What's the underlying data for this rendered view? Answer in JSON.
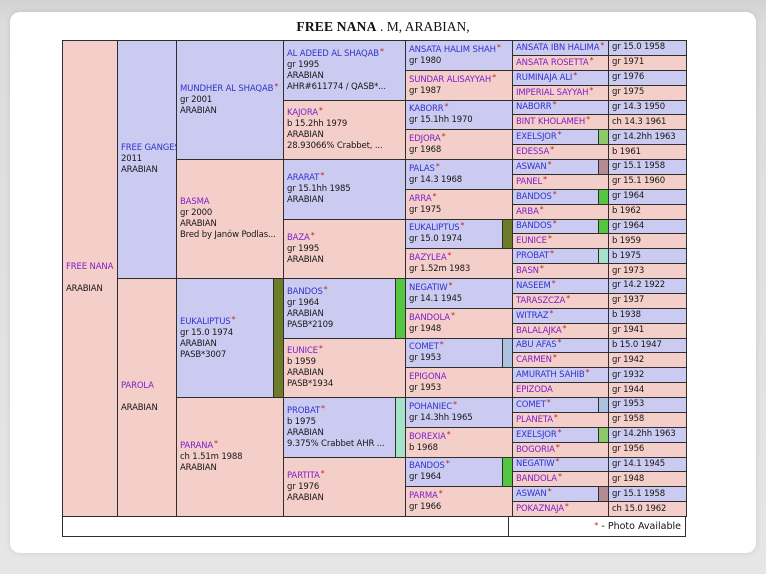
{
  "page": {
    "title_name": "FREE NANA",
    "title_suffix": " . M, ARABIAN,"
  },
  "footer": {
    "star": "*",
    "note": "- Photo Available"
  },
  "colors": {
    "male_bg": "#cbcbf1",
    "female_bg": "#f4cfca",
    "male_name": "#3232cd",
    "female_name": "#7d1ec8",
    "photo_star": "#c42222",
    "border": "#2e2e2e",
    "dup_eukaliptus": "#6e7b28",
    "dup_bandos": "#54c641",
    "dup_probat": "#a4e3c8",
    "dup_comet": "#aac4de",
    "dup_exelsjor": "#8bc96b",
    "dup_aswan": "#b28b93"
  },
  "pedigree": {
    "columns": [
      {
        "cells": [
          {
            "span": 32,
            "sex": "f",
            "name": "FREE NANA",
            "details": [
              "",
              "ARABIAN"
            ]
          }
        ]
      },
      {
        "cells": [
          {
            "span": 16,
            "sex": "m",
            "name": "FREE GANGES",
            "details": [
              "2011",
              "ARABIAN"
            ]
          },
          {
            "span": 16,
            "sex": "f",
            "name": "PAROLA",
            "details": [
              "",
              "ARABIAN"
            ]
          }
        ]
      },
      {
        "cells": [
          {
            "span": 8,
            "sex": "m",
            "name": "MUNDHER AL SHAQAB",
            "star": "*",
            "details": [
              "gr 2001",
              "ARABIAN"
            ]
          },
          {
            "span": 8,
            "sex": "f",
            "name": "BASMA",
            "details": [
              "gr 2000",
              "ARABIAN",
              "Bred by Janów Podlas..."
            ]
          },
          {
            "span": 8,
            "sex": "m",
            "name": "EUKALIPTUS",
            "star": "*",
            "details": [
              "gr 15.0 1974",
              "ARABIAN",
              "PASB*3007"
            ],
            "dup_color": "#6e7b28"
          },
          {
            "span": 8,
            "sex": "f",
            "name": "PARANA",
            "star": "*",
            "details": [
              "ch 1.51m 1988",
              "ARABIAN"
            ]
          }
        ]
      },
      {
        "cells": [
          {
            "span": 4,
            "sex": "m",
            "name": "AL ADEED AL SHAQAB",
            "star": "*",
            "details": [
              "gr 1995",
              "ARABIAN",
              "AHR#611774 / QASB*..."
            ]
          },
          {
            "span": 4,
            "sex": "f",
            "name": "KAJORA",
            "star": "*",
            "details": [
              "b 15.2hh 1979",
              "ARABIAN",
              "28.93066% Crabbet, ..."
            ]
          },
          {
            "span": 4,
            "sex": "m",
            "name": "ARARAT",
            "star": "*",
            "details": [
              "gr 15.1hh 1985",
              "ARABIAN"
            ]
          },
          {
            "span": 4,
            "sex": "f",
            "name": "BAZA",
            "star": "*",
            "details": [
              "gr 1995",
              "ARABIAN"
            ]
          },
          {
            "span": 4,
            "sex": "m",
            "name": "BANDOS",
            "star": "*",
            "details": [
              "gr 1964",
              "ARABIAN",
              "PASB*2109"
            ],
            "dup_color": "#54c641"
          },
          {
            "span": 4,
            "sex": "f",
            "name": "EUNICE",
            "star": "*",
            "details": [
              "b 1959",
              "ARABIAN",
              "PASB*1934"
            ]
          },
          {
            "span": 4,
            "sex": "m",
            "name": "PROBAT",
            "star": "*",
            "details": [
              "b 1975",
              "ARABIAN",
              "9.375% Crabbet AHR ..."
            ],
            "dup_color": "#a4e3c8"
          },
          {
            "span": 4,
            "sex": "f",
            "name": "PARTITA",
            "star": "*",
            "details": [
              "gr 1976",
              "ARABIAN"
            ]
          }
        ]
      },
      {
        "cells": [
          {
            "span": 2,
            "sex": "m",
            "name": "ANSATA HALIM SHAH",
            "star": "*",
            "details": [
              "gr 1980"
            ]
          },
          {
            "span": 2,
            "sex": "f",
            "name": "SUNDAR ALISAYYAH",
            "star": "*",
            "details": [
              "gr 1987"
            ]
          },
          {
            "span": 2,
            "sex": "m",
            "name": "KABORR",
            "star": "*",
            "details": [
              "gr 15.1hh 1970"
            ]
          },
          {
            "span": 2,
            "sex": "f",
            "name": "EDJORA",
            "star": "*",
            "details": [
              "gr 1968"
            ]
          },
          {
            "span": 2,
            "sex": "m",
            "name": "PALAS",
            "star": "*",
            "details": [
              "gr 14.3 1968"
            ]
          },
          {
            "span": 2,
            "sex": "f",
            "name": "ARRA",
            "star": "*",
            "details": [
              "gr 1975"
            ]
          },
          {
            "span": 2,
            "sex": "m",
            "name": "EUKALIPTUS",
            "star": "*",
            "details": [
              "gr 15.0 1974"
            ],
            "dup_color": "#6e7b28"
          },
          {
            "span": 2,
            "sex": "f",
            "name": "BAZYLEA",
            "star": "*",
            "details": [
              "gr 1.52m 1983"
            ]
          },
          {
            "span": 2,
            "sex": "m",
            "name": "NEGATIW",
            "star": "*",
            "details": [
              "gr 14.1 1945"
            ]
          },
          {
            "span": 2,
            "sex": "f",
            "name": "BANDOLA",
            "star": "*",
            "details": [
              "gr 1948"
            ]
          },
          {
            "span": 2,
            "sex": "m",
            "name": "COMET",
            "star": "*",
            "details": [
              "gr 1953"
            ],
            "dup_color": "#aac4de"
          },
          {
            "span": 2,
            "sex": "f",
            "name": "EPIGONA",
            "details": [
              "gr 1953"
            ]
          },
          {
            "span": 2,
            "sex": "m",
            "name": "POHANIEC",
            "star": "*",
            "details": [
              "gr 14.3hh 1965"
            ]
          },
          {
            "span": 2,
            "sex": "f",
            "name": "BOREXIA",
            "star": "*",
            "details": [
              "b 1968"
            ]
          },
          {
            "span": 2,
            "sex": "m",
            "name": "BANDOS",
            "star": "*",
            "details": [
              "gr 1964"
            ],
            "dup_color": "#54c641"
          },
          {
            "span": 2,
            "sex": "f",
            "name": "PARMA",
            "star": "*",
            "details": [
              "gr 1966"
            ]
          }
        ]
      },
      {
        "cells": [
          {
            "span": 1,
            "sex": "m",
            "name": "ANSATA IBN HALIMA",
            "star": "*"
          },
          {
            "span": 1,
            "sex": "f",
            "name": "ANSATA ROSETTA",
            "star": "*"
          },
          {
            "span": 1,
            "sex": "m",
            "name": "RUMINAJA ALI",
            "star": "*"
          },
          {
            "span": 1,
            "sex": "f",
            "name": "IMPERIAL SAYYAH",
            "star": "*"
          },
          {
            "span": 1,
            "sex": "m",
            "name": "NABORR",
            "star": "*"
          },
          {
            "span": 1,
            "sex": "f",
            "name": "BINT KHOLAMEH",
            "star": "*"
          },
          {
            "span": 1,
            "sex": "m",
            "name": "EXELSJOR",
            "star": "*",
            "dup_color": "#8bc96b"
          },
          {
            "span": 1,
            "sex": "f",
            "name": "EDESSA",
            "star": "*"
          },
          {
            "span": 1,
            "sex": "m",
            "name": "ASWAN",
            "star": "*",
            "dup_color": "#b28b93"
          },
          {
            "span": 1,
            "sex": "f",
            "name": "PANEL",
            "star": "*"
          },
          {
            "span": 1,
            "sex": "m",
            "name": "BANDOS",
            "star": "*",
            "dup_color": "#54c641"
          },
          {
            "span": 1,
            "sex": "f",
            "name": "ARBA",
            "star": "*"
          },
          {
            "span": 1,
            "sex": "m",
            "name": "BANDOS",
            "star": "*",
            "dup_color": "#54c641"
          },
          {
            "span": 1,
            "sex": "f",
            "name": "EUNICE",
            "star": "*"
          },
          {
            "span": 1,
            "sex": "m",
            "name": "PROBAT",
            "star": "*",
            "dup_color": "#a4e3c8"
          },
          {
            "span": 1,
            "sex": "f",
            "name": "BASN",
            "star": "*"
          },
          {
            "span": 1,
            "sex": "m",
            "name": "NASEEM",
            "star": "*"
          },
          {
            "span": 1,
            "sex": "f",
            "name": "TARASZCZA",
            "star": "*"
          },
          {
            "span": 1,
            "sex": "m",
            "name": "WITRAZ",
            "star": "*"
          },
          {
            "span": 1,
            "sex": "f",
            "name": "BALALAJKA",
            "star": "*"
          },
          {
            "span": 1,
            "sex": "m",
            "name": "ABU AFAS",
            "star": "*"
          },
          {
            "span": 1,
            "sex": "f",
            "name": "CARMEN",
            "star": "*"
          },
          {
            "span": 1,
            "sex": "m",
            "name": "AMURATH SAHIB",
            "star": "*"
          },
          {
            "span": 1,
            "sex": "f",
            "name": "EPIZODA"
          },
          {
            "span": 1,
            "sex": "m",
            "name": "COMET",
            "star": "*",
            "dup_color": "#aac4de"
          },
          {
            "span": 1,
            "sex": "f",
            "name": "PLANETA",
            "star": "*"
          },
          {
            "span": 1,
            "sex": "m",
            "name": "EXELSJOR",
            "star": "*",
            "dup_color": "#8bc96b"
          },
          {
            "span": 1,
            "sex": "f",
            "name": "BOGORIA",
            "star": "*"
          },
          {
            "span": 1,
            "sex": "m",
            "name": "NEGATIW",
            "star": "*"
          },
          {
            "span": 1,
            "sex": "f",
            "name": "BANDOLA",
            "star": "*"
          },
          {
            "span": 1,
            "sex": "m",
            "name": "ASWAN",
            "star": "*",
            "dup_color": "#b28b93"
          },
          {
            "span": 1,
            "sex": "f",
            "name": "POKAZNAJA",
            "star": "*"
          }
        ]
      },
      {
        "cells": [
          {
            "span": 1,
            "sex": "m",
            "text": "gr 15.0 1958"
          },
          {
            "span": 1,
            "sex": "f",
            "text": "gr 1971"
          },
          {
            "span": 1,
            "sex": "m",
            "text": "gr 1976"
          },
          {
            "span": 1,
            "sex": "f",
            "text": "gr 1975"
          },
          {
            "span": 1,
            "sex": "m",
            "text": "gr 14.3 1950"
          },
          {
            "span": 1,
            "sex": "f",
            "text": "ch 14.3 1961"
          },
          {
            "span": 1,
            "sex": "m",
            "text": "gr 14.2hh 1963"
          },
          {
            "span": 1,
            "sex": "f",
            "text": "b 1961"
          },
          {
            "span": 1,
            "sex": "m",
            "text": "gr 15.1 1958"
          },
          {
            "span": 1,
            "sex": "f",
            "text": "gr 15.1 1960"
          },
          {
            "span": 1,
            "sex": "m",
            "text": "gr 1964"
          },
          {
            "span": 1,
            "sex": "f",
            "text": "b 1962"
          },
          {
            "span": 1,
            "sex": "m",
            "text": "gr 1964"
          },
          {
            "span": 1,
            "sex": "f",
            "text": "b 1959"
          },
          {
            "span": 1,
            "sex": "m",
            "text": "b 1975"
          },
          {
            "span": 1,
            "sex": "f",
            "text": "gr 1973"
          },
          {
            "span": 1,
            "sex": "m",
            "text": "gr 14.2 1922"
          },
          {
            "span": 1,
            "sex": "f",
            "text": "gr 1937"
          },
          {
            "span": 1,
            "sex": "m",
            "text": "b 1938"
          },
          {
            "span": 1,
            "sex": "f",
            "text": "gr 1941"
          },
          {
            "span": 1,
            "sex": "m",
            "text": "b 15.0 1947"
          },
          {
            "span": 1,
            "sex": "f",
            "text": "gr 1942"
          },
          {
            "span": 1,
            "sex": "m",
            "text": "gr 1932"
          },
          {
            "span": 1,
            "sex": "f",
            "text": "gr 1944"
          },
          {
            "span": 1,
            "sex": "m",
            "text": "gr 1953"
          },
          {
            "span": 1,
            "sex": "f",
            "text": "gr 1958"
          },
          {
            "span": 1,
            "sex": "m",
            "text": "gr 14.2hh 1963"
          },
          {
            "span": 1,
            "sex": "f",
            "text": "gr 1956"
          },
          {
            "span": 1,
            "sex": "m",
            "text": "gr 14.1 1945"
          },
          {
            "span": 1,
            "sex": "f",
            "text": "gr 1948"
          },
          {
            "span": 1,
            "sex": "m",
            "text": "gr 15.1 1958"
          },
          {
            "span": 1,
            "sex": "f",
            "text": "ch 15.0 1962"
          }
        ]
      }
    ]
  }
}
